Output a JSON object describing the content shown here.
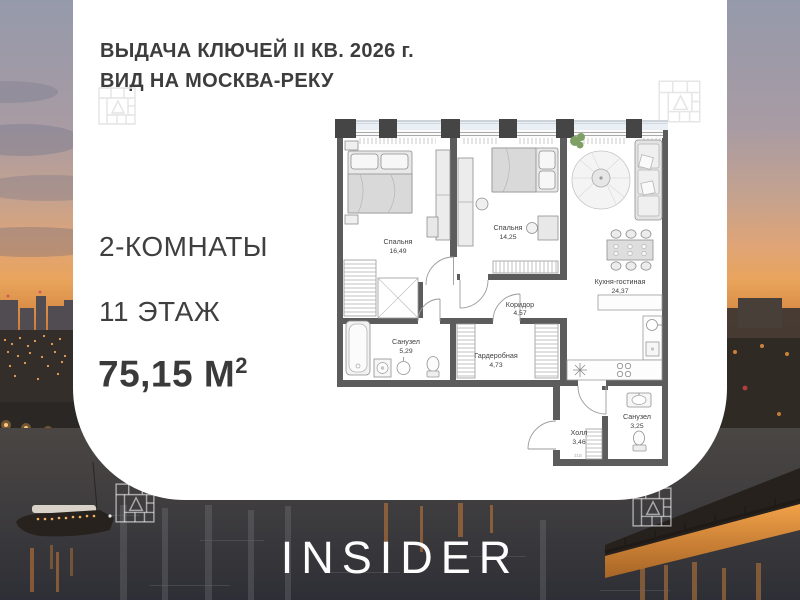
{
  "header": {
    "line1": "ВЫДАЧА КЛЮЧЕЙ II КВ. 2026 г.",
    "line2": "ВИД НА МОСКВА-РЕКУ"
  },
  "summary": {
    "rooms": "2-КОМНАТЫ",
    "floor": "11 ЭТАЖ",
    "area_value": "75,15",
    "area_unit": "М",
    "area_sup": "2"
  },
  "floorplan": {
    "rooms": [
      {
        "name": "Спальня",
        "area": "16,49"
      },
      {
        "name": "Спальня",
        "area": "14,25"
      },
      {
        "name": "Кухня-гостиная",
        "area": "24,37"
      },
      {
        "name": "Коридор",
        "area": "4,57"
      },
      {
        "name": "Санузел",
        "area": "5,29"
      },
      {
        "name": "Гардеробная",
        "area": "4,73"
      },
      {
        "name": "Санузел",
        "area": "3,25"
      },
      {
        "name": "Холл",
        "area": "3,46"
      }
    ],
    "stamp": "31В"
  },
  "brand": {
    "logo": "INSIDER"
  },
  "colors": {
    "card_bg": "#ffffff",
    "text_dark": "#3d3d3d",
    "wall": "#5c5c5c",
    "sunset_orange": "#e9a45c",
    "water_dark": "#35343a",
    "balcony_tint": "#e9eff4",
    "logo_white": "#fdfdfd"
  }
}
